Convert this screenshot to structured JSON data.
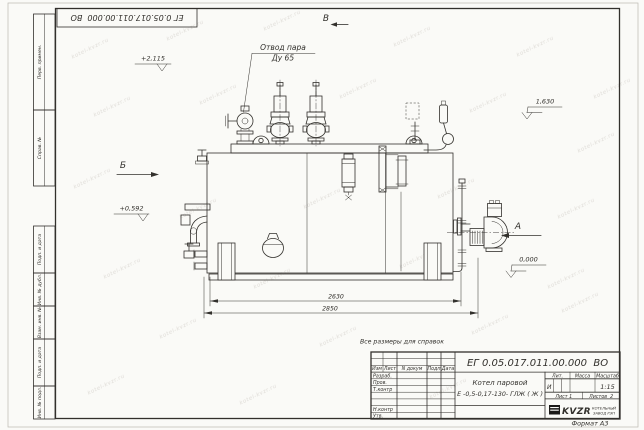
{
  "sheet": {
    "designation": "ЕГ 0.05.017.011.00.000  ВО",
    "reference_note": "Все размеры для справок",
    "format_note": "Формат А3"
  },
  "margin": {
    "top_block": [
      "Перв. примен.",
      "Справ. №"
    ],
    "bottom_block": [
      "Подп. и дата",
      "Инв. № дубл.",
      "Взам. инв. №",
      "Подп. и дата",
      "Инв. № подл."
    ]
  },
  "title_block": {
    "designation": "ЕГ 0.05.017.011.00.000  ВО",
    "product_name_line1": "Котел паровой",
    "product_name_line2": "Е -0,5-0,17-130- ГЛЖ ( Ж )",
    "col_headers": {
      "izm": "Изм",
      "list": "Лист",
      "doc": "N докум",
      "podp": "Подп",
      "date": "Дата"
    },
    "row_labels": {
      "razrab": "Разраб.",
      "prov": "Пров.",
      "tkontr": "Т.контр",
      "nkontr": "Н.контр",
      "utv": "Утв."
    },
    "lit_header": "Лит.",
    "massa_header": "Масса",
    "scale_header": "Масштаб",
    "lit_value": "И",
    "scale_value": "1:15",
    "sheet_no": "Лист 1",
    "sheets_total": "Листов  2",
    "logo_text": "KVZR",
    "company_line1": "КОТЕЛЬНЫЙ",
    "company_line2": "ЗАВОД РЭП"
  },
  "annotations": {
    "callout_line1": "Отвод пара",
    "callout_line2": "Ду 65",
    "view_b_top": "В",
    "view_b_left": "Б",
    "view_a_right": "А",
    "elev_top_left": "+2,115",
    "elev_mid_left": "+0,592",
    "elev_right": "1,630",
    "elev_ground": "0,000",
    "dim_length_inner": "2630",
    "dim_length_outer": "2850"
  },
  "watermark": {
    "text": "kotel-kvzr.ru"
  }
}
